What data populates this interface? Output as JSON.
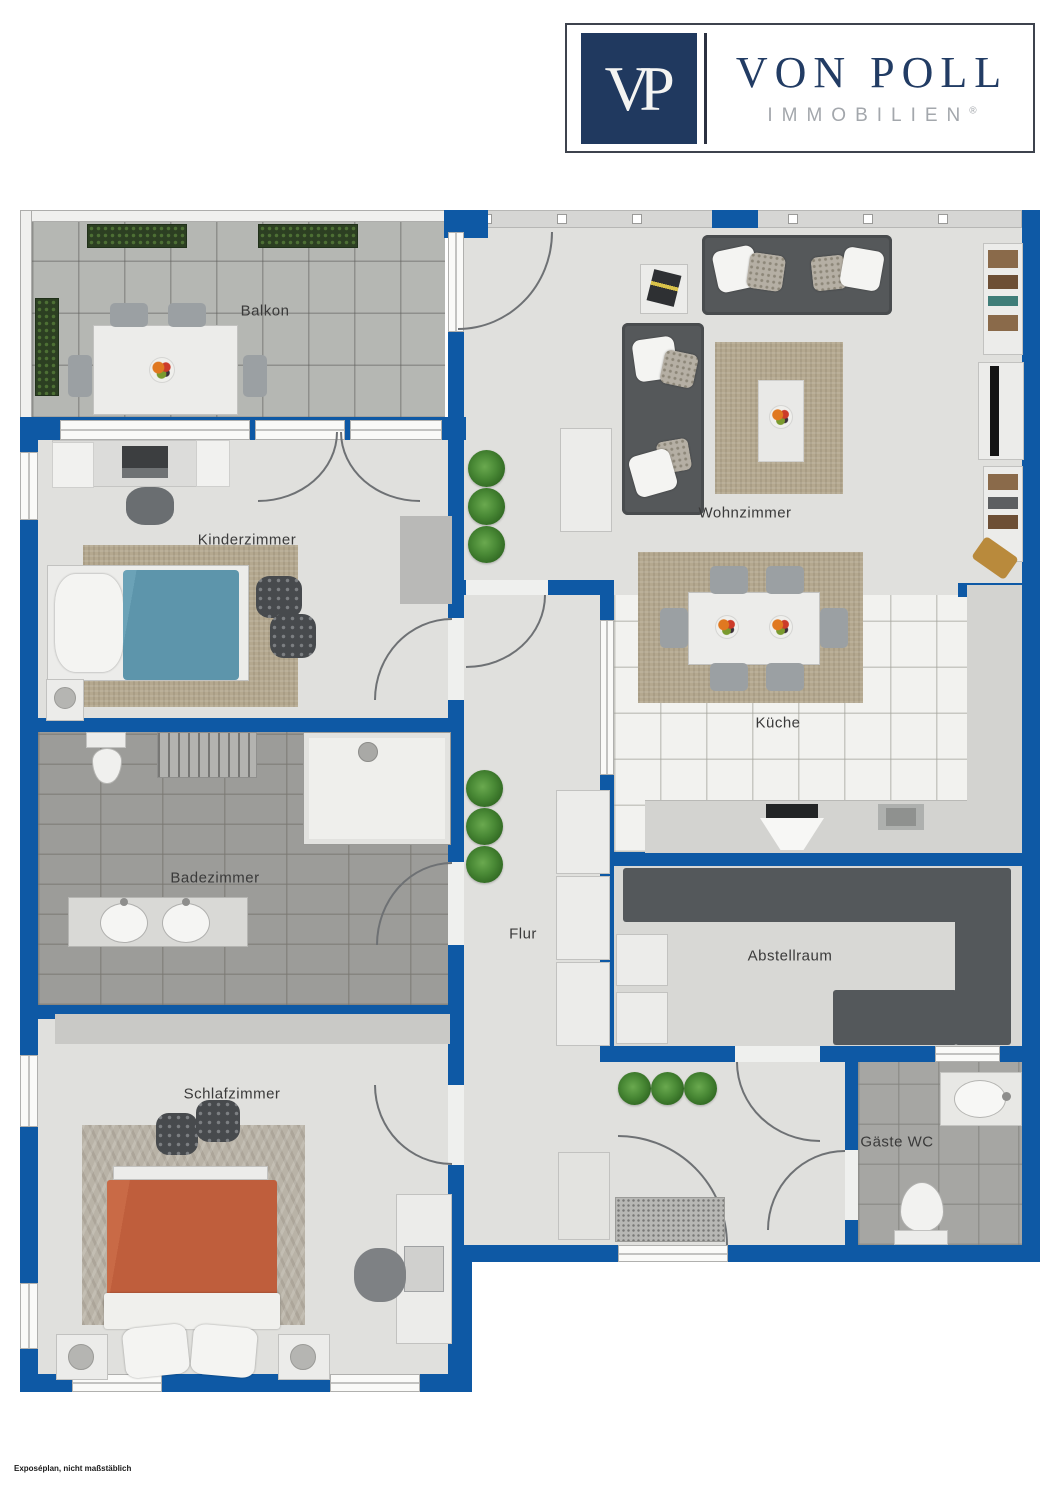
{
  "brand": {
    "monogram": "VP",
    "name": "VON POLL",
    "subtitle": "IMMOBILIEN",
    "registered_mark": "®"
  },
  "rooms": {
    "balkon": {
      "label": "Balkon"
    },
    "wohnzimmer": {
      "label": "Wohnzimmer"
    },
    "kinderzimmer": {
      "label": "Kinderzimmer"
    },
    "kueche": {
      "label": "Küche"
    },
    "badezimmer": {
      "label": "Badezimmer"
    },
    "flur": {
      "label": "Flur"
    },
    "abstellraum": {
      "label": "Abstellraum"
    },
    "schlafzimmer": {
      "label": "Schlafzimmer"
    },
    "gaeste_wc": {
      "label": "Gäste WC"
    }
  },
  "footer": {
    "note": "Exposéplan, nicht maßstäblich"
  },
  "colors": {
    "wall_blue": "#0e59a5",
    "brand_navy": "#20395f",
    "brand_gray": "#a3a7ac",
    "floor_light": "#e0e0dd",
    "balcony_tile": "#b5b7b3",
    "bath_tile": "#9c9c99",
    "kitchen_tile": "#f2f2ef",
    "wc_tile": "#a6a6a3",
    "sofa_gray": "#55585a",
    "rug_beige": "#b4a88f",
    "bed_teal": "#5d95ab",
    "bed_terracotta": "#bf5e3c",
    "plant_green": "#3f7a2f",
    "shelf_dark": "#54585b"
  }
}
